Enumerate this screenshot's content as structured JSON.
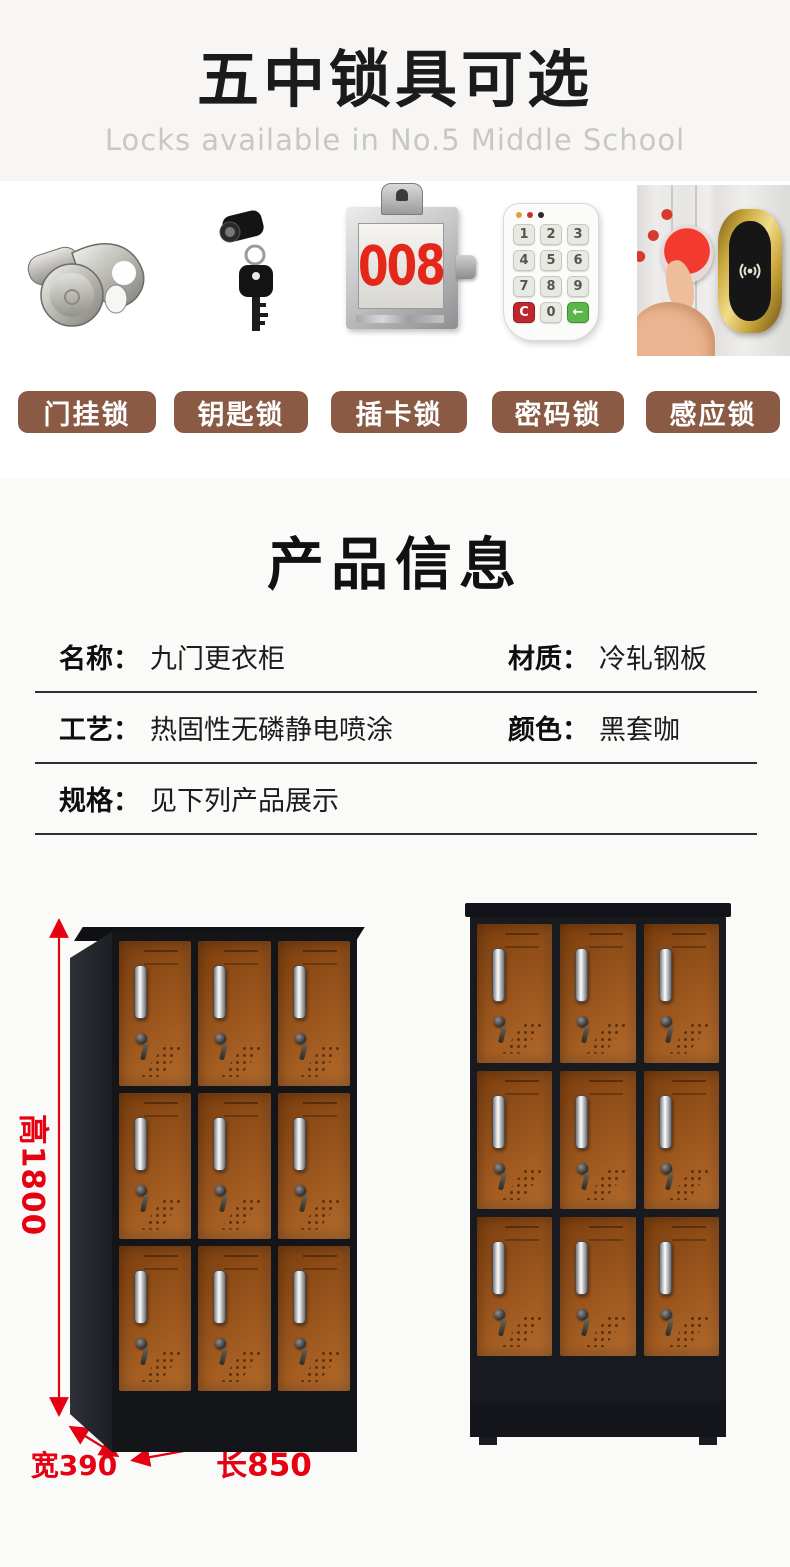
{
  "header": {
    "title": "五中锁具可选",
    "subtitle": "Locks available in No.5 Middle School",
    "bg_color": "#f7f6f4",
    "subtitle_color": "#c8c7c5"
  },
  "locks": {
    "button_color": "#8a5a44",
    "items": [
      {
        "label": "门挂锁",
        "icon": "hasp-lock-icon"
      },
      {
        "label": "钥匙锁",
        "icon": "key-lock-icon"
      },
      {
        "label": "插卡锁",
        "icon": "card-lock-icon",
        "card_number": "008"
      },
      {
        "label": "密码锁",
        "icon": "keypad-lock-icon",
        "keypad_keys": [
          "1",
          "2",
          "3",
          "4",
          "5",
          "6",
          "7",
          "8",
          "9",
          "C",
          "0",
          "←"
        ]
      },
      {
        "label": "感应锁",
        "icon": "rfid-lock-icon"
      }
    ]
  },
  "product_info": {
    "title": "产品信息",
    "rows": [
      {
        "left_label": "名称：",
        "left_value": "九门更衣柜",
        "right_label": "材质：",
        "right_value": "冷轧钢板"
      },
      {
        "left_label": "工艺：",
        "left_value": "热固性无磷静电喷涂",
        "right_label": "颜色：",
        "right_value": "黑套咖"
      },
      {
        "left_label": "规格：",
        "left_value": "见下列产品展示",
        "right_label": "",
        "right_value": ""
      }
    ]
  },
  "display": {
    "dimension_color": "#e60012",
    "height_label": "高1800",
    "width_label": "宽390",
    "length_label": "长850",
    "locker": {
      "rows": 3,
      "cols": 3,
      "door_color": "#9a571d",
      "frame_color": "#17181c"
    }
  }
}
